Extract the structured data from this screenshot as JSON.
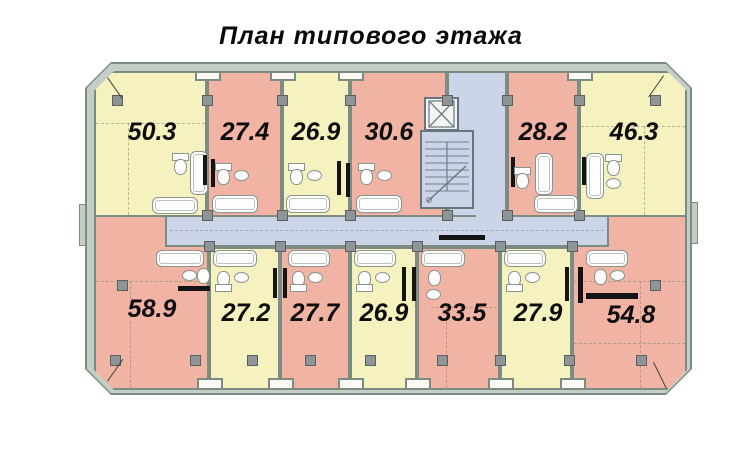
{
  "title": "План типового этажа",
  "colors": {
    "apartment_pink": "#f1b3a3",
    "apartment_yellow": "#f6f2c0",
    "common_area_blue": "#ccd4e8",
    "wall_gray_green": "#7c8c83"
  },
  "plan": {
    "top_row": [
      {
        "area": "50.3",
        "color": "yellow"
      },
      {
        "area": "27.4",
        "color": "pink"
      },
      {
        "area": "26.9",
        "color": "yellow"
      },
      {
        "area": "30.6",
        "color": "pink"
      },
      {
        "area": "28.2",
        "color": "pink"
      },
      {
        "area": "46.3",
        "color": "yellow"
      }
    ],
    "bottom_row": [
      {
        "area": "58.9",
        "color": "pink"
      },
      {
        "area": "27.2",
        "color": "yellow"
      },
      {
        "area": "27.7",
        "color": "pink"
      },
      {
        "area": "26.9",
        "color": "yellow"
      },
      {
        "area": "33.5",
        "color": "pink"
      },
      {
        "area": "27.9",
        "color": "yellow"
      },
      {
        "area": "54.8",
        "color": "pink"
      }
    ]
  }
}
